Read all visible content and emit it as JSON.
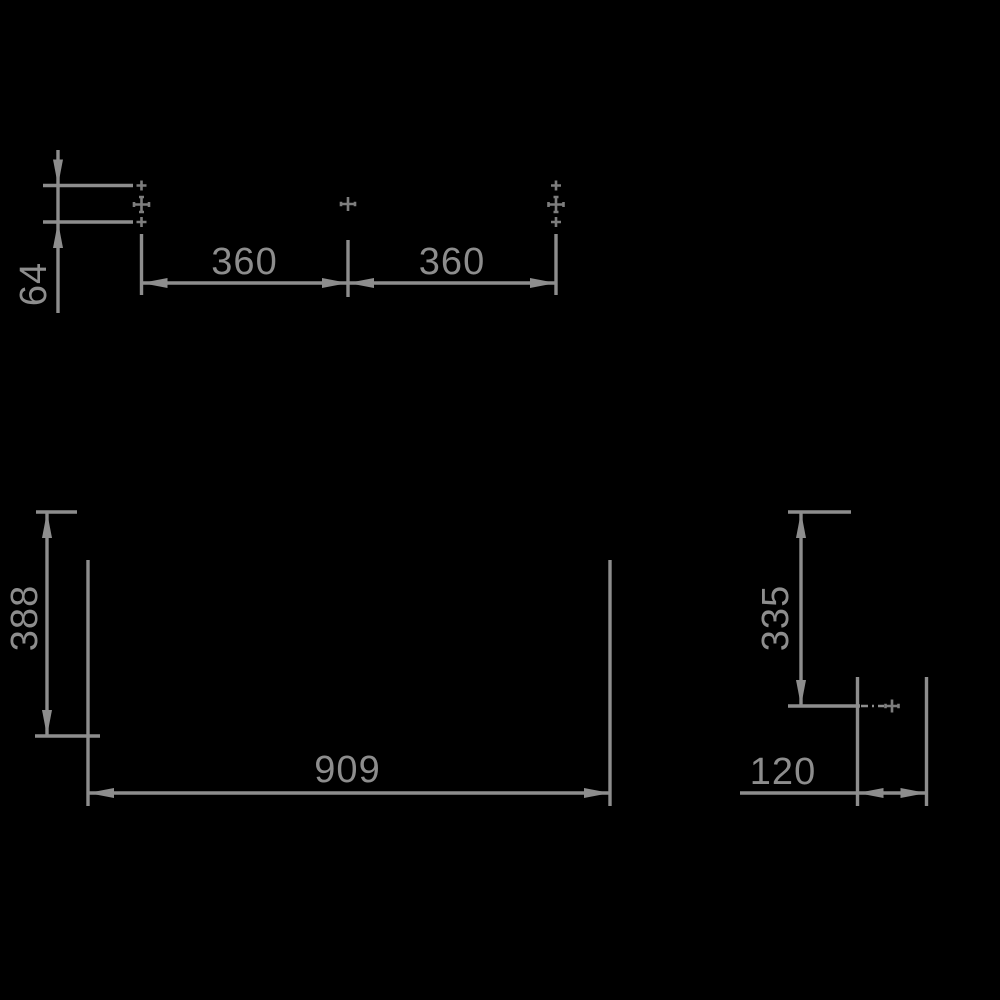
{
  "drawing": {
    "kind": "technical-dimension-drawing",
    "background_color": "#000000",
    "line_color": "#8d8d8d",
    "marker_color": "#7d7d7d",
    "labels": {
      "hole_offset_vertical": "64",
      "hole_pitch_left": "360",
      "hole_pitch_right": "360",
      "height_left": "388",
      "overall_width": "909",
      "height_right": "335",
      "side_width": "120"
    },
    "markers": {
      "icon": "crosshair-icon",
      "count": 8
    }
  }
}
